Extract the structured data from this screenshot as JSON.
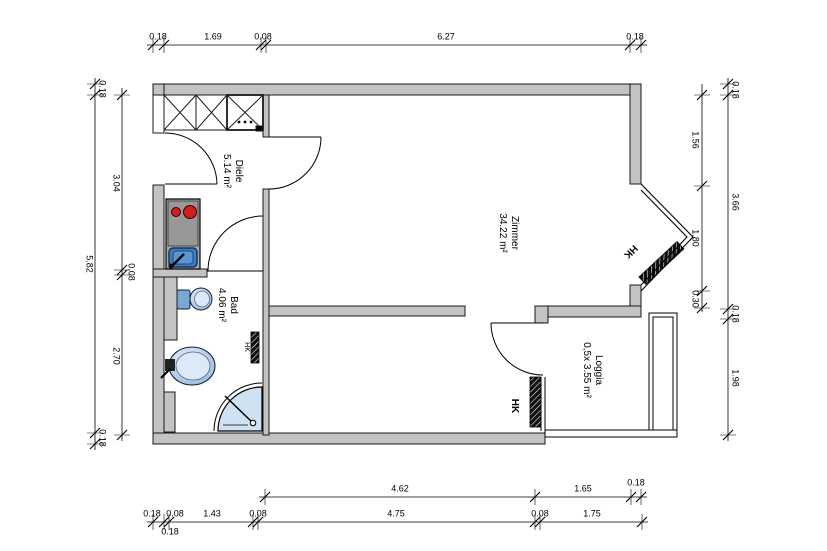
{
  "rooms": {
    "diele": {
      "name": "Diele",
      "area": "5.14 m²"
    },
    "zimmer": {
      "name": "Zimmer",
      "area": "34.22 m²"
    },
    "bad": {
      "name": "Bad",
      "area": "4.06 m²"
    },
    "loggia": {
      "name": "Loggia",
      "area": "0,5x 3.55 m²"
    }
  },
  "radiator_label": "HK",
  "dims": {
    "top": [
      "0.18",
      "1.69",
      "0.08",
      "6.27",
      "0.18"
    ],
    "left_outer": [
      "0.18",
      "5.82",
      "0.18"
    ],
    "left_inner": [
      "3.04",
      "0.08",
      "2.70"
    ],
    "right_inner": [
      "1.56",
      "1.80",
      "0.30"
    ],
    "right_outer": [
      "0.18",
      "3.66",
      "0.18",
      "1.98"
    ],
    "bottom_upper": [
      "4.62",
      "1.65",
      "0.18"
    ],
    "bottom_lower": [
      "0.18",
      "0.08",
      "1.43",
      "0.08",
      "4.75",
      "0.08",
      "1.75"
    ],
    "bottom_below": "0.18"
  },
  "colors": {
    "wall": "#c3c3c3",
    "fixture_light": "#cfe2f3",
    "fixture_mid": "#9fc5e8",
    "sink_dark": "#3f7ec0",
    "burner_red": "#cf1f1f",
    "line": "#000000"
  }
}
